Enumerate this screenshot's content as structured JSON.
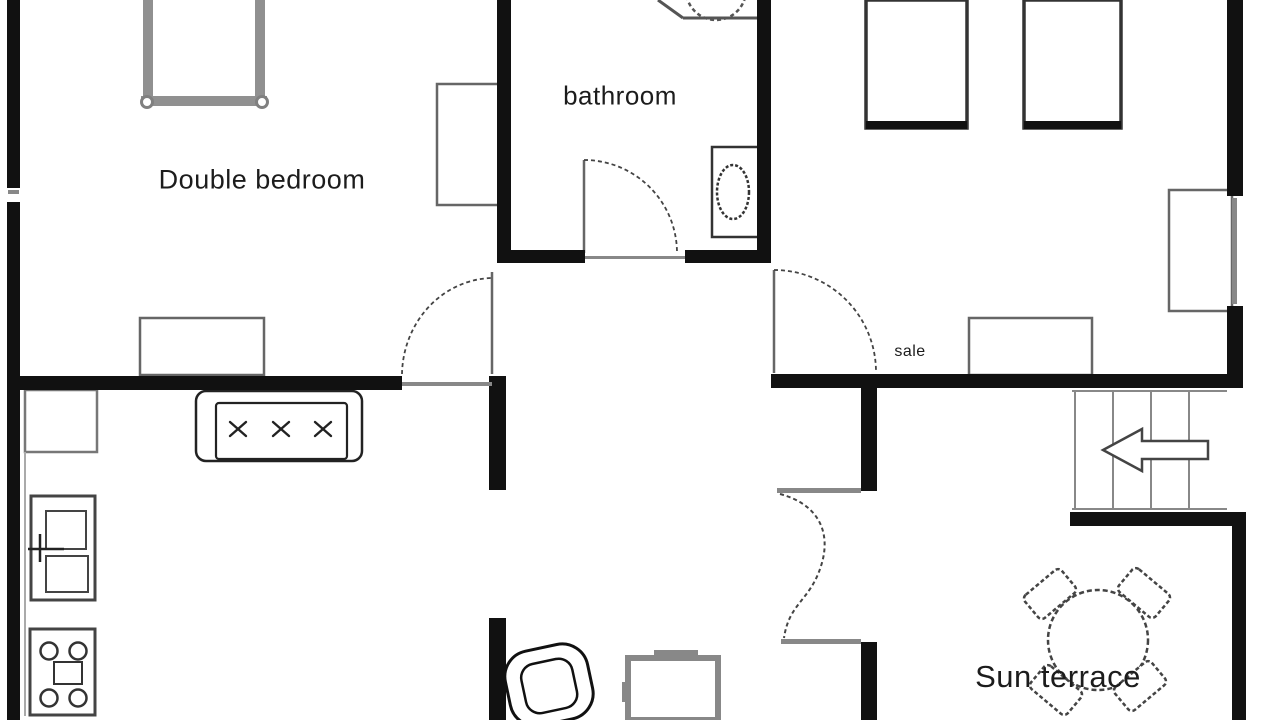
{
  "plan": {
    "labels": {
      "double_bedroom": "Double bedroom",
      "bathroom": "bathroom",
      "sale": "sale",
      "sun_terrace": "Sun terrace"
    },
    "colors": {
      "wall": "#111111",
      "door_line": "#666666",
      "threshold": "#888888",
      "furniture_dark": "#333333",
      "furniture_mid": "#666666",
      "furniture_light": "#999999",
      "background": "#ffffff",
      "label_text": "#1c1c1c"
    },
    "symbols": [
      "double-bed",
      "wardrobe",
      "dresser",
      "sofa",
      "kitchen-counter",
      "fridge-freezer",
      "stove",
      "toilet",
      "corner-basin",
      "single-bed",
      "desk",
      "staircase",
      "stairs-direction-arrow",
      "armchair",
      "side-table",
      "round-table",
      "terrace-chair",
      "door-swing",
      "french-doors",
      "window"
    ]
  }
}
